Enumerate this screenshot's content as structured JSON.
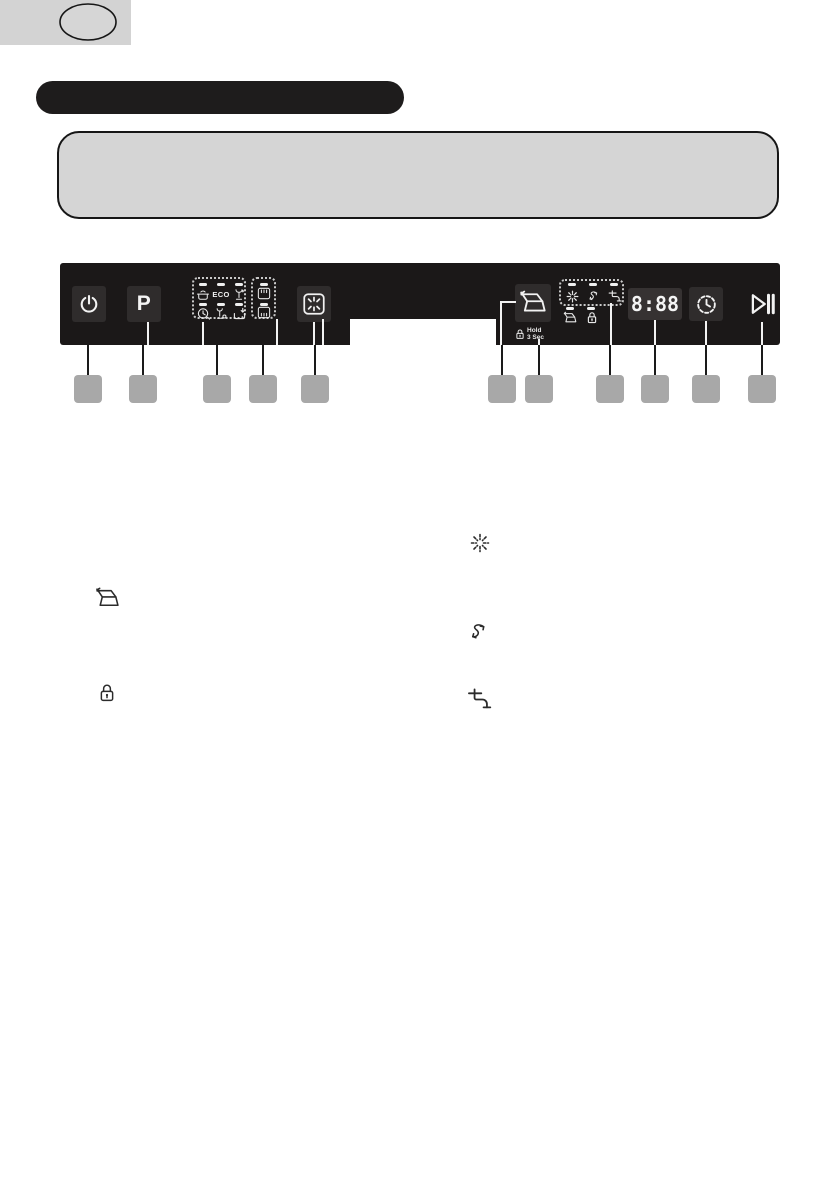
{
  "page_badge": {
    "shape": "oval-outline",
    "text": ""
  },
  "title_bar": {
    "text": ""
  },
  "info_box": {
    "text": ""
  },
  "panel": {
    "power_button": {
      "icon": "power-icon"
    },
    "program_button": {
      "label": "P"
    },
    "programs": [
      {
        "icon": "intensive-pot-icon"
      },
      {
        "label": "ECO"
      },
      {
        "icon": "glass-wash-icon"
      },
      {
        "icon": "quick-clock-icon"
      },
      {
        "icon": "rapid-glass-drop-icon"
      },
      {
        "icon": "soak-basket-icon"
      }
    ],
    "half_load": [
      {
        "icon": "upper-rack-icon"
      },
      {
        "icon": "lower-rack-icon"
      }
    ],
    "extra_dry_button": {
      "icon": "extra-dry-icon"
    },
    "door_open_button": {
      "icon": "auto-door-open-icon"
    },
    "child_lock": {
      "icon": "lock-icon",
      "label_line1": "Hold",
      "label_line2": "3 Sec"
    },
    "indicators": [
      {
        "icon": "rinse-aid-icon"
      },
      {
        "icon": "salt-refill-icon"
      },
      {
        "icon": "water-tap-icon"
      },
      {
        "icon": "door-open-indicator-icon"
      },
      {
        "icon": "lock-indicator-icon"
      }
    ],
    "display": {
      "value": "8:88"
    },
    "delay_button": {
      "icon": "delay-timer-icon"
    },
    "start_pause_button": {
      "icon": "start-pause-icon"
    }
  },
  "callouts": {
    "labels": [
      "",
      "",
      "",
      "",
      "",
      "",
      "",
      "",
      "",
      "",
      ""
    ]
  },
  "legend": {
    "left": [
      {
        "icon": "auto-door-open-icon"
      },
      {
        "icon": "child-lock-icon"
      }
    ],
    "right": [
      {
        "icon": "rinse-aid-icon"
      },
      {
        "icon": "salt-refill-icon"
      },
      {
        "icon": "water-tap-icon"
      }
    ]
  },
  "colors": {
    "panel_bg": "#1b1818",
    "button_bg": "#2f2c2c",
    "callout_square": "#a8a8a8",
    "badge_gray": "#d3d3d3",
    "info_box_gray": "#d5d5d5"
  }
}
